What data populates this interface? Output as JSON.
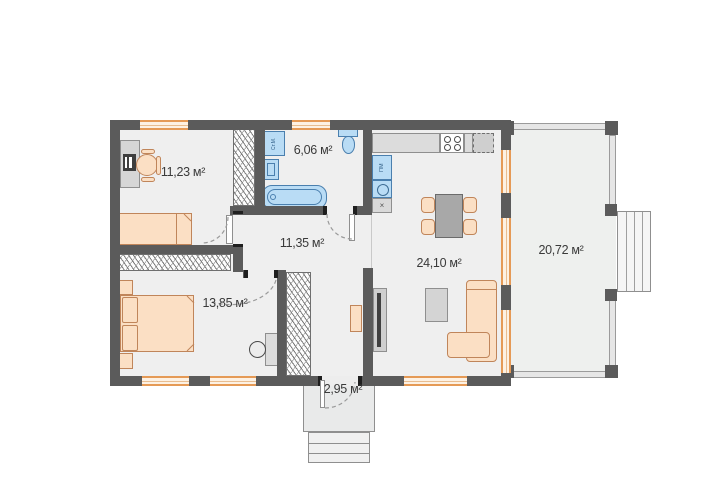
{
  "rooms": {
    "bedroom1": {
      "label": "11,23 м²"
    },
    "bathroom": {
      "label": "6,06 м²"
    },
    "hallway": {
      "label": "11,35 м²"
    },
    "kitchen_living": {
      "label": "24,10 м²"
    },
    "terrace": {
      "label": "20,72 м²"
    },
    "bedroom2": {
      "label": "13,85 м²"
    },
    "porch": {
      "label": "2,95 м²"
    }
  },
  "fixtures": {
    "washing_machine_label": "Ст.М.",
    "dishwasher_label": "ПМ",
    "kitchen_module_label": "×"
  },
  "colors": {
    "wall": "#5b5b5b",
    "floor": "#efefef",
    "furniture_wood": "#fbdfc4",
    "furniture_wood_border": "#c0855a",
    "plumbing_blue": "#b9dcf5",
    "plumbing_blue_border": "#4a7fae",
    "window_accent": "#e59a56",
    "label_text": "#3a3a3a"
  }
}
